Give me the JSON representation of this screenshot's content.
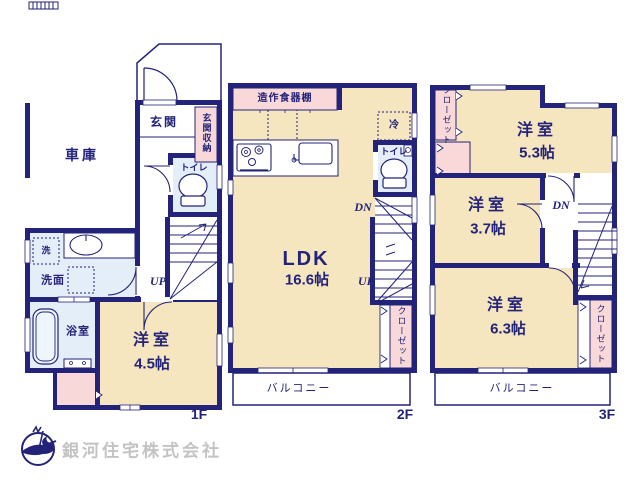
{
  "colors": {
    "wall_navy": "#232379",
    "room_beige": "#f6e6bf",
    "accent_pink": "#f8d8d8",
    "wet_area_blue": "#e4eef8",
    "logo_gray": "#c3c3c3"
  },
  "floor1": {
    "floor_label": "1F",
    "garage": "車庫",
    "entrance": "玄関",
    "entrance_storage": "玄関収納",
    "toilet": "トイレ",
    "laundry": "洗",
    "washroom": "洗面",
    "bathroom": "浴室",
    "bedroom_name": "洋室",
    "bedroom_size": "4.5帖",
    "stairs_up": "UP"
  },
  "floor2": {
    "floor_label": "2F",
    "cupboard": "造作食器棚",
    "refrigerator": "冷",
    "toilet": "トイレ",
    "ldk_name": "LDK",
    "ldk_size": "16.6帖",
    "stairs_down": "DN",
    "stairs_up": "UP",
    "closet": "クローゼット",
    "balcony": "バルコニー"
  },
  "floor3": {
    "floor_label": "3F",
    "closet_top": "クローゼット",
    "bedroom1_name": "洋室",
    "bedroom1_size": "5.3帖",
    "bedroom2_name": "洋室",
    "bedroom2_size": "3.7帖",
    "bedroom3_name": "洋室",
    "bedroom3_size": "6.3帖",
    "stairs_down": "DN",
    "closet_bottom": "クローゼット",
    "balcony": "バルコニー"
  },
  "footer": {
    "company_name": "銀河住宅株式会社"
  }
}
